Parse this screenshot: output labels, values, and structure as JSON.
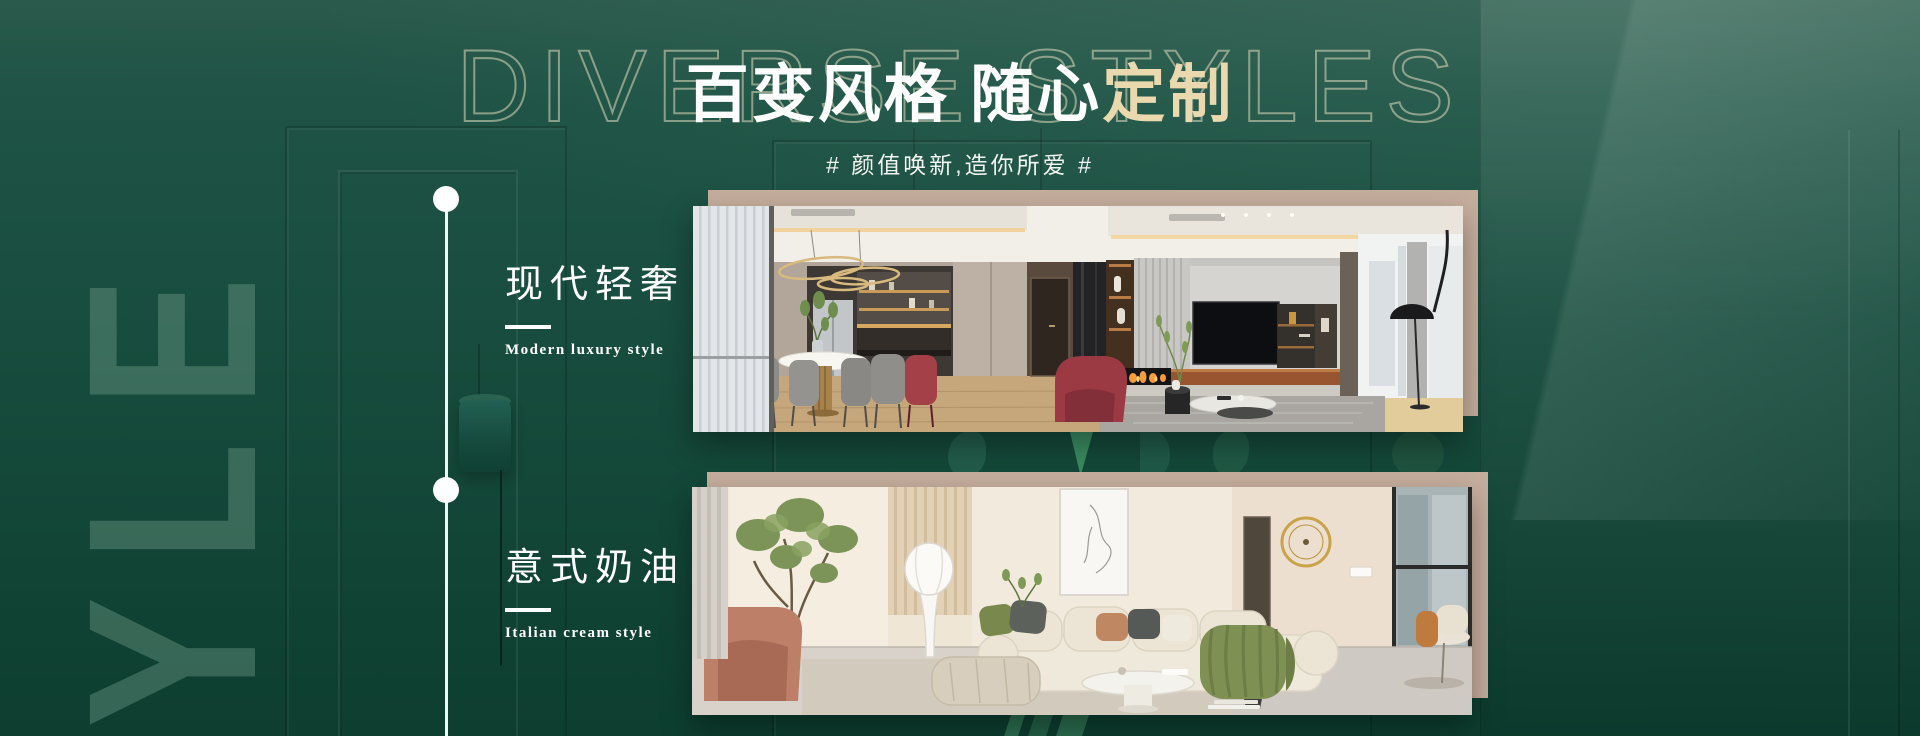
{
  "hero": {
    "watermark": "DIVERSE STYLES",
    "title_white": "百变风格 随心",
    "title_cream": "定制",
    "subtitle": "# 颜值唤新,造你所爱 #",
    "side_word": "YLE"
  },
  "styles": [
    {
      "zh": "现代轻奢",
      "en": "Modern luxury style"
    },
    {
      "zh": "意式奶油",
      "en": "Italian cream style"
    }
  ],
  "colors": {
    "background_green": "#174c3e",
    "accent_cream": "#EAD9AE",
    "card_beige": "#C6AE9D",
    "text_white": "#FFFFFF",
    "ghost_green": "#3F9668"
  }
}
